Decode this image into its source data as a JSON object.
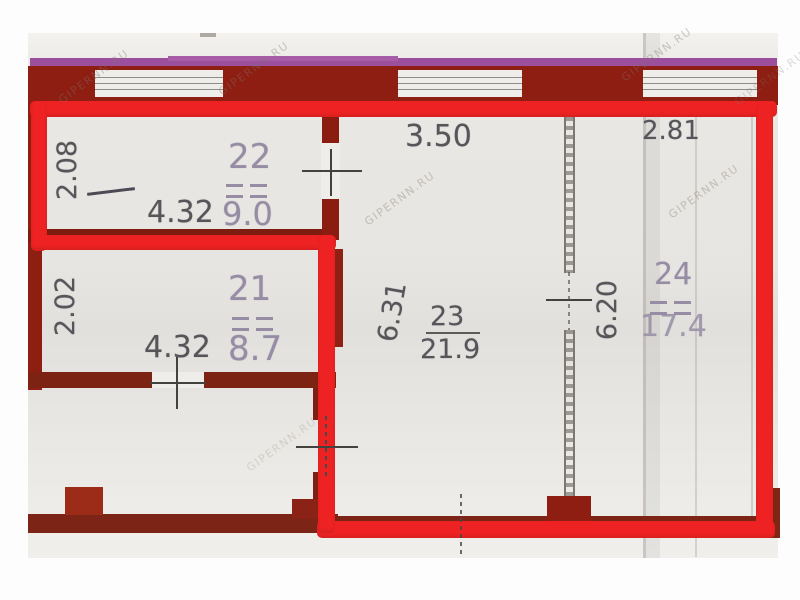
{
  "watermark": "GIPERNN.RU",
  "rooms": [
    {
      "number": "22",
      "area": "9.0",
      "width": "4.32",
      "depth": "2.08"
    },
    {
      "number": "21",
      "area": "8.7",
      "width": "4.32",
      "depth": "2.02"
    },
    {
      "number": "23",
      "area": "21.9",
      "width": "3.50",
      "depth": "6.31"
    },
    {
      "number": "24",
      "area": "17.4",
      "width": "2.81",
      "depth": "6.20"
    }
  ],
  "colors": {
    "highlight_outline": "#ee2222",
    "wall": "#8e1d12",
    "boundary_line": "#9c4f9c",
    "paper": "#e9e7e3",
    "pencil": "#57555a",
    "faded_ink": "#968da4"
  }
}
